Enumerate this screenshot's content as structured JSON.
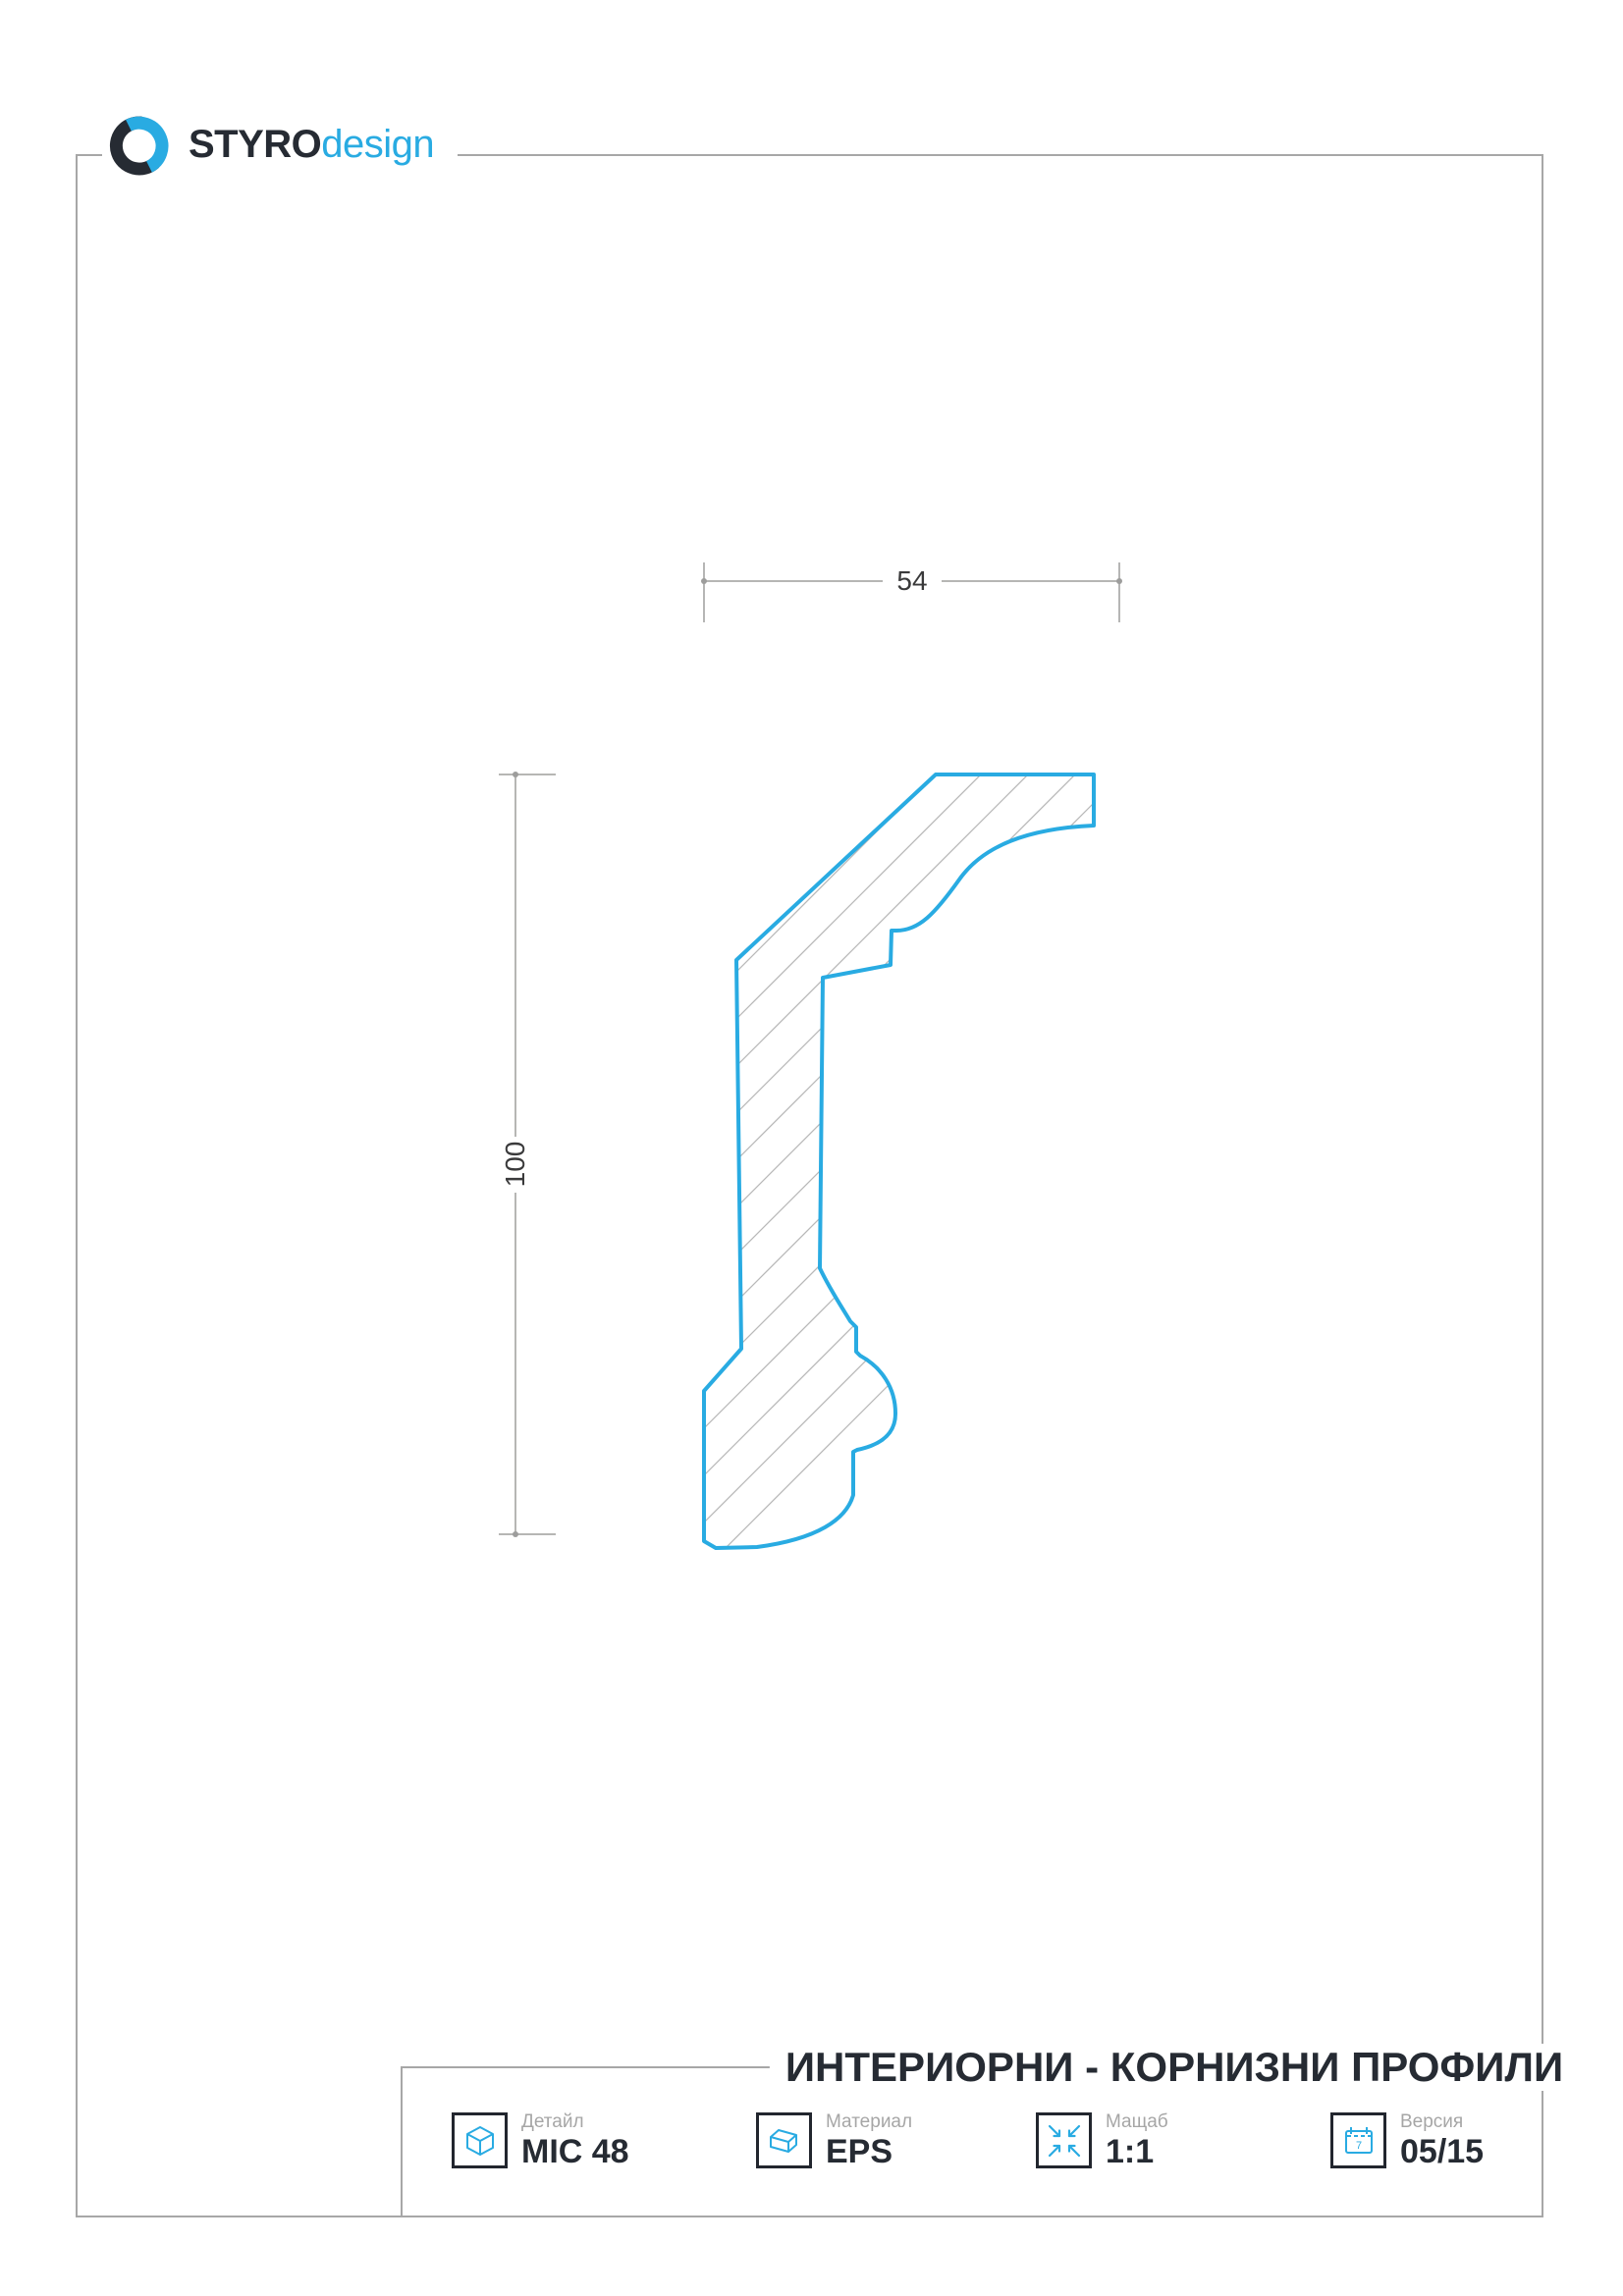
{
  "logo": {
    "brand_bold": "STYRO",
    "brand_light": "design",
    "icon": "styro-swirl-icon"
  },
  "drawing": {
    "type": "cornice-profile-section",
    "dim_width_label": "54",
    "dim_height_label": "100"
  },
  "title_block": {
    "title": "ИНТЕРИОРНИ - КОРНИЗНИ ПРОФИЛИ",
    "items": [
      {
        "label": "Детайл",
        "value": "MIC 48",
        "icon": "cube-icon"
      },
      {
        "label": "Материал",
        "value": "EPS",
        "icon": "material-block-icon"
      },
      {
        "label": "Мащаб",
        "value": "1:1",
        "icon": "scale-arrows-icon"
      },
      {
        "label": "Версия",
        "value": "05/15",
        "icon": "calendar-icon",
        "icon_text": "7"
      }
    ]
  },
  "colors": {
    "accent_blue": "#29ABE2",
    "dark": "#262B33",
    "frame_gray": "#A7A7A7",
    "dim_gray": "#9D9D9C",
    "dim_text": "#3A3A3B",
    "hatch_gray": "#B8B8B8",
    "label_gray": "#A6A6A6"
  }
}
